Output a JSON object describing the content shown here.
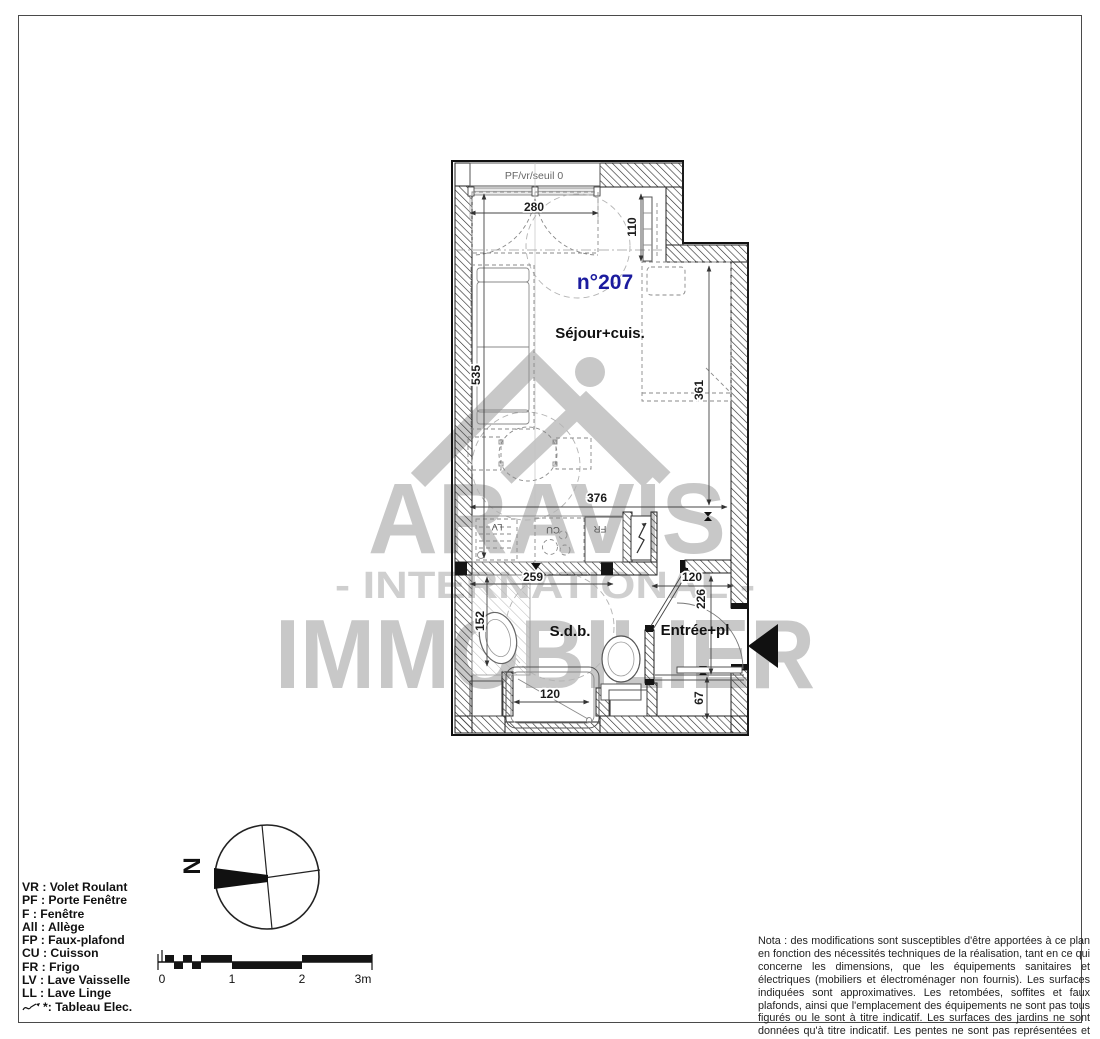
{
  "plan": {
    "unit_label": "n°207",
    "window_label": "PF/vr/seuil 0",
    "rooms": {
      "sejour": "Séjour+cuis.",
      "sdb": "S.d.b.",
      "entree": "Entrée+pl"
    },
    "appliances": {
      "lv": "LV",
      "cu": "CU",
      "fr": "FR"
    },
    "dims": {
      "window_width": "280",
      "alcove_depth": "110",
      "sejour_length": "535",
      "bed_wall": "361",
      "sejour_width": "376",
      "sdb_width": "259",
      "entree_width": "120",
      "entree_depth": "226",
      "sdb_left_width": "152",
      "bath_width": "120",
      "placard_depth": "67"
    },
    "colors": {
      "unit_number": "#1b1b9e",
      "watermark": "#c8c8c8",
      "linework": "#222222"
    }
  },
  "watermark": {
    "brand": "ARAVIS",
    "subtitle": "- INTERNATIONAL -",
    "brand2": "IMMOBILIER",
    "logo_icon": "mountain-peaks-icon"
  },
  "compass": {
    "north_label": "N"
  },
  "scale_bar": {
    "labels": [
      "0",
      "1",
      "2",
      "3m"
    ]
  },
  "legend": {
    "items": [
      "VR : Volet Roulant",
      "PF : Porte Fenêtre",
      "F : Fenêtre",
      "All : Allège",
      "FP : Faux-plafond",
      "CU : Cuisson",
      "FR : Frigo",
      "LV : Lave Vaisselle",
      "LL : Lave Linge"
    ],
    "tableau": {
      "star": "*",
      "label": " : Tableau Elec.",
      "icon": "electric-zigzag-icon"
    }
  },
  "nota": {
    "text": "Nota : des modifications sont susceptibles d'être apportées à ce plan en fonction des nécessités techniques de la réalisation, tant en ce qui concerne les dimensions, que les équipements sanitaires et électriques (mobiliers et électroménager non fournis). Les surfaces indiquées sont approximatives. Les retombées, soffites et faux plafonds, ainsi que l'emplacement des équipements ne sont pas tous figurés ou le sont à titre indicatif. Les surfaces des jardins ne sont données qu'à titre indicatif. Les pentes ne sont pas représentées et seront adaptées en fonction du terrain naturel."
  }
}
